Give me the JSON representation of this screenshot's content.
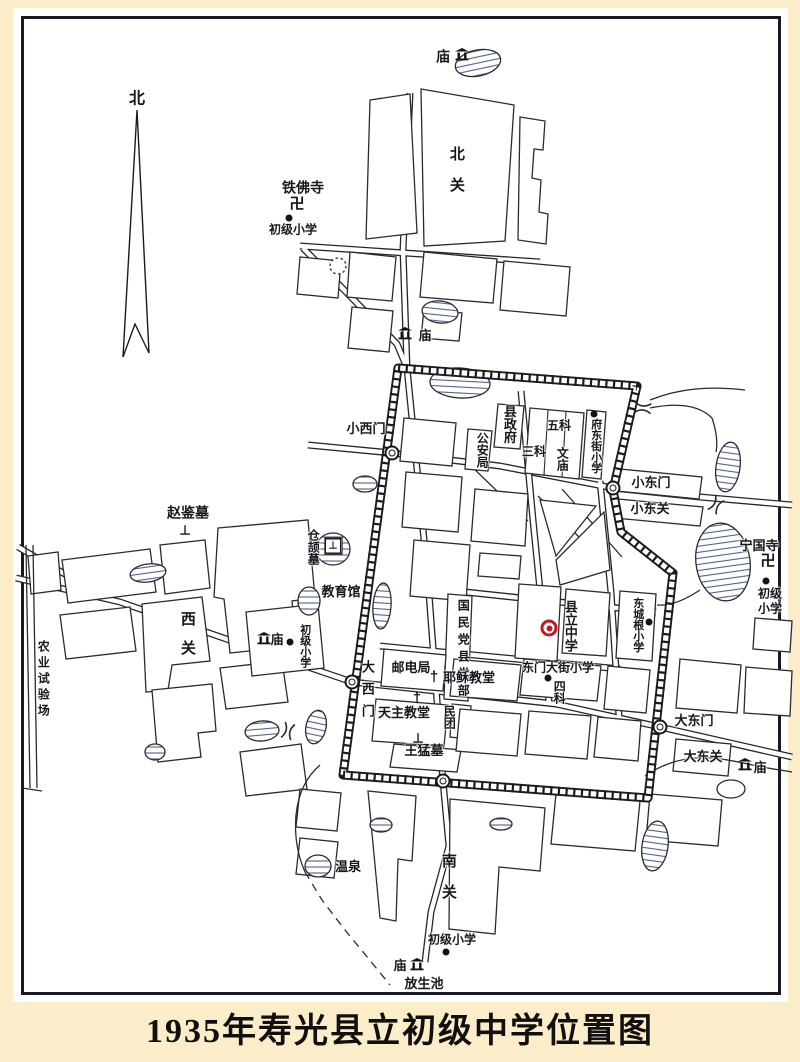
{
  "title": "1935年寿光县立初级中学位置图",
  "colors": {
    "paper": "#fcedca",
    "map_background": "#ffffff",
    "frame": "#191926",
    "ink": "#17171d",
    "school_marker_red": "#c8161e",
    "water_hatch": "#51618c"
  },
  "labels": [
    {
      "text": "北",
      "x": 137,
      "y": 100,
      "size": 16
    },
    {
      "text": "庙",
      "x": 443,
      "y": 57,
      "size": 14
    },
    {
      "text": "北关",
      "x": 456,
      "y": 177,
      "size": 15,
      "vertical": true,
      "spacing": 16
    },
    {
      "text": "铁佛寺",
      "x": 303,
      "y": 188,
      "size": 14
    },
    {
      "text": "初级小学",
      "x": 293,
      "y": 230,
      "size": 12
    },
    {
      "text": "庙",
      "x": 425,
      "y": 336,
      "size": 13
    },
    {
      "text": "小西门",
      "x": 366,
      "y": 429,
      "size": 13
    },
    {
      "text": "县政府",
      "x": 509,
      "y": 424,
      "size": 13,
      "vertical": true
    },
    {
      "text": "公安局",
      "x": 482,
      "y": 450,
      "size": 12,
      "vertical": true
    },
    {
      "text": "三科",
      "x": 534,
      "y": 452,
      "size": 12
    },
    {
      "text": "五科",
      "x": 559,
      "y": 426,
      "size": 12
    },
    {
      "text": "文庙",
      "x": 562,
      "y": 459,
      "size": 12,
      "vertical": true
    },
    {
      "text": "府东街小学",
      "x": 595,
      "y": 446,
      "size": 11,
      "vertical": true
    },
    {
      "text": "小东门",
      "x": 651,
      "y": 483,
      "size": 13
    },
    {
      "text": "小东关",
      "x": 650,
      "y": 509,
      "size": 13
    },
    {
      "text": "赵鉴墓",
      "x": 188,
      "y": 513,
      "size": 14
    },
    {
      "text": "仓颉墓",
      "x": 313,
      "y": 547,
      "size": 12,
      "vertical": true
    },
    {
      "text": "教育馆",
      "x": 341,
      "y": 592,
      "size": 13
    },
    {
      "text": "西关",
      "x": 187,
      "y": 640,
      "size": 15,
      "vertical": true,
      "spacing": 14
    },
    {
      "text": "农业试验场",
      "x": 43,
      "y": 680,
      "size": 12,
      "vertical": true,
      "spacing": 4
    },
    {
      "text": "庙",
      "x": 277,
      "y": 640,
      "size": 13
    },
    {
      "text": "初级小学",
      "x": 304,
      "y": 646,
      "size": 11,
      "vertical": true
    },
    {
      "text": "宁国寺",
      "x": 759,
      "y": 546,
      "size": 13
    },
    {
      "text": "初级",
      "x": 770,
      "y": 594,
      "size": 12
    },
    {
      "text": "小学",
      "x": 770,
      "y": 609,
      "size": 12
    },
    {
      "text": "东城根小学",
      "x": 637,
      "y": 625,
      "size": 11,
      "vertical": true
    },
    {
      "text": "县立中学",
      "x": 570,
      "y": 626,
      "size": 13,
      "vertical": true
    },
    {
      "text": "国民党县党部",
      "x": 463,
      "y": 650,
      "size": 12,
      "vertical": true,
      "spacing": 5
    },
    {
      "text": "大西门",
      "x": 367,
      "y": 693,
      "size": 13,
      "vertical": true,
      "spacing": 9
    },
    {
      "text": "邮电局",
      "x": 411,
      "y": 668,
      "size": 13
    },
    {
      "text": "耶稣教堂",
      "x": 469,
      "y": 678,
      "size": 13
    },
    {
      "text": "天主教堂",
      "x": 404,
      "y": 713,
      "size": 13
    },
    {
      "text": "民团",
      "x": 449,
      "y": 717,
      "size": 12,
      "vertical": true
    },
    {
      "text": "王猛墓",
      "x": 424,
      "y": 751,
      "size": 13
    },
    {
      "text": "东门大街小学",
      "x": 558,
      "y": 668,
      "size": 12
    },
    {
      "text": "四科",
      "x": 559,
      "y": 692,
      "size": 12,
      "vertical": true
    },
    {
      "text": "大东门",
      "x": 694,
      "y": 721,
      "size": 13
    },
    {
      "text": "大东关",
      "x": 703,
      "y": 757,
      "size": 13
    },
    {
      "text": "庙",
      "x": 760,
      "y": 768,
      "size": 13
    },
    {
      "text": "温泉",
      "x": 348,
      "y": 867,
      "size": 13
    },
    {
      "text": "南关",
      "x": 448,
      "y": 884,
      "size": 15,
      "vertical": true,
      "spacing": 16
    },
    {
      "text": "初级小学",
      "x": 452,
      "y": 940,
      "size": 12
    },
    {
      "text": "庙",
      "x": 400,
      "y": 966,
      "size": 13
    },
    {
      "text": "放生池",
      "x": 424,
      "y": 984,
      "size": 13
    }
  ],
  "markers": [
    {
      "type": "dot",
      "x": 289,
      "y": 218
    },
    {
      "type": "dot",
      "x": 594,
      "y": 414
    },
    {
      "type": "dot",
      "x": 290,
      "y": 642
    },
    {
      "type": "dot",
      "x": 766,
      "y": 581
    },
    {
      "type": "dot",
      "x": 649,
      "y": 622
    },
    {
      "type": "dot",
      "x": 548,
      "y": 678
    },
    {
      "type": "dot",
      "x": 446,
      "y": 952
    },
    {
      "type": "target",
      "x": 549,
      "y": 628
    },
    {
      "type": "swastika",
      "x": 297,
      "y": 204,
      "glyph": "卍"
    },
    {
      "type": "swastika",
      "x": 768,
      "y": 561,
      "glyph": "卍"
    },
    {
      "type": "cross",
      "x": 434,
      "y": 677,
      "glyph": "†"
    },
    {
      "type": "cross",
      "x": 417,
      "y": 698,
      "glyph": "†"
    },
    {
      "type": "grave",
      "x": 185,
      "y": 530,
      "glyph": "⊥"
    },
    {
      "type": "grave",
      "x": 418,
      "y": 738,
      "glyph": "⊥"
    },
    {
      "type": "grave-square",
      "x": 333,
      "y": 546,
      "glyph": "⊥"
    },
    {
      "type": "temple",
      "x": 462,
      "y": 54
    },
    {
      "type": "temple",
      "x": 405,
      "y": 333
    },
    {
      "type": "temple",
      "x": 264,
      "y": 638
    },
    {
      "type": "temple",
      "x": 745,
      "y": 764
    },
    {
      "type": "temple",
      "x": 417,
      "y": 964
    },
    {
      "type": "gate",
      "x": 392,
      "y": 453
    },
    {
      "type": "gate",
      "x": 352,
      "y": 682
    },
    {
      "type": "gate",
      "x": 613,
      "y": 488
    },
    {
      "type": "gate",
      "x": 660,
      "y": 727
    },
    {
      "type": "gate",
      "x": 443,
      "y": 781
    }
  ]
}
